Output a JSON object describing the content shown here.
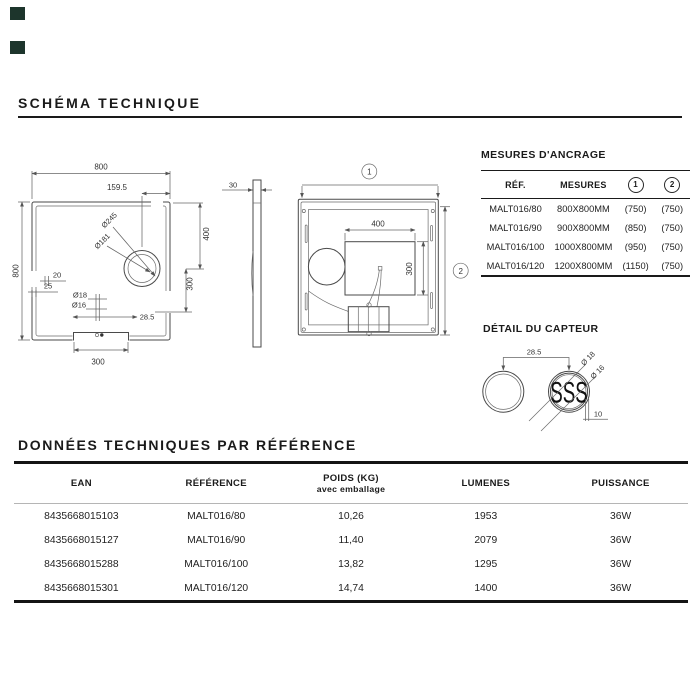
{
  "page": {
    "corner_marks_color": "#1d352c"
  },
  "schema": {
    "title": "SCHÉMA TECHNIQUE"
  },
  "front": {
    "dim_width_top": "800",
    "dim_offset": "159.5",
    "dim_height_left": "800",
    "dim_20": "20",
    "dim_25": "25",
    "dim_d245": "Ø245",
    "dim_d181": "Ø181",
    "dim_400": "400",
    "dim_300_right": "300",
    "dim_d18": "Ø18",
    "dim_d16": "Ø16",
    "dim_285": "28.5",
    "dim_300_bottom": "300"
  },
  "side": {
    "dim_thickness": "30"
  },
  "rear": {
    "callout_1": "1",
    "callout_2": "2",
    "dim_400": "400",
    "dim_300": "300"
  },
  "anchoring": {
    "title": "MESURES D'ANCRAGE",
    "headers": {
      "ref": "RÉF.",
      "mesures": "MESURES",
      "c1": "1",
      "c2": "2"
    },
    "rows": [
      {
        "ref": "MALT016/80",
        "mesures": "800X800MM",
        "v1": "(750)",
        "v2": "(750)"
      },
      {
        "ref": "MALT016/90",
        "mesures": "900X800MM",
        "v1": "(850)",
        "v2": "(750)"
      },
      {
        "ref": "MALT016/100",
        "mesures": "1000X800MM",
        "v1": "(950)",
        "v2": "(750)"
      },
      {
        "ref": "MALT016/120",
        "mesures": "1200X800MM",
        "v1": "(1150)",
        "v2": "(750)"
      }
    ]
  },
  "sensor": {
    "title": "DÉTAIL DU CAPTEUR",
    "dim_spacing": "28.5",
    "dim_d18": "Ø 18",
    "dim_d16": "Ø 16",
    "dim_depth": "10",
    "label": "SSS"
  },
  "tech": {
    "title": "DONNÉES TECHNIQUES PAR RÉFÉRENCE",
    "headers": {
      "ean": "EAN",
      "reference": "RÉFÉRENCE",
      "poids_l1": "POIDS (KG)",
      "poids_l2": "avec emballage",
      "lumens": "LUMENES",
      "puissance": "PUISSANCE"
    },
    "rows": [
      {
        "ean": "8435668015103",
        "reference": "MALT016/80",
        "poids": "10,26",
        "lumens": "1953",
        "puissance": "36W"
      },
      {
        "ean": "8435668015127",
        "reference": "MALT016/90",
        "poids": "11,40",
        "lumens": "2079",
        "puissance": "36W"
      },
      {
        "ean": "8435668015288",
        "reference": "MALT016/100",
        "poids": "13,82",
        "lumens": "1295",
        "puissance": "36W"
      },
      {
        "ean": "8435668015301",
        "reference": "MALT016/120",
        "poids": "14,74",
        "lumens": "1400",
        "puissance": "36W"
      }
    ]
  }
}
